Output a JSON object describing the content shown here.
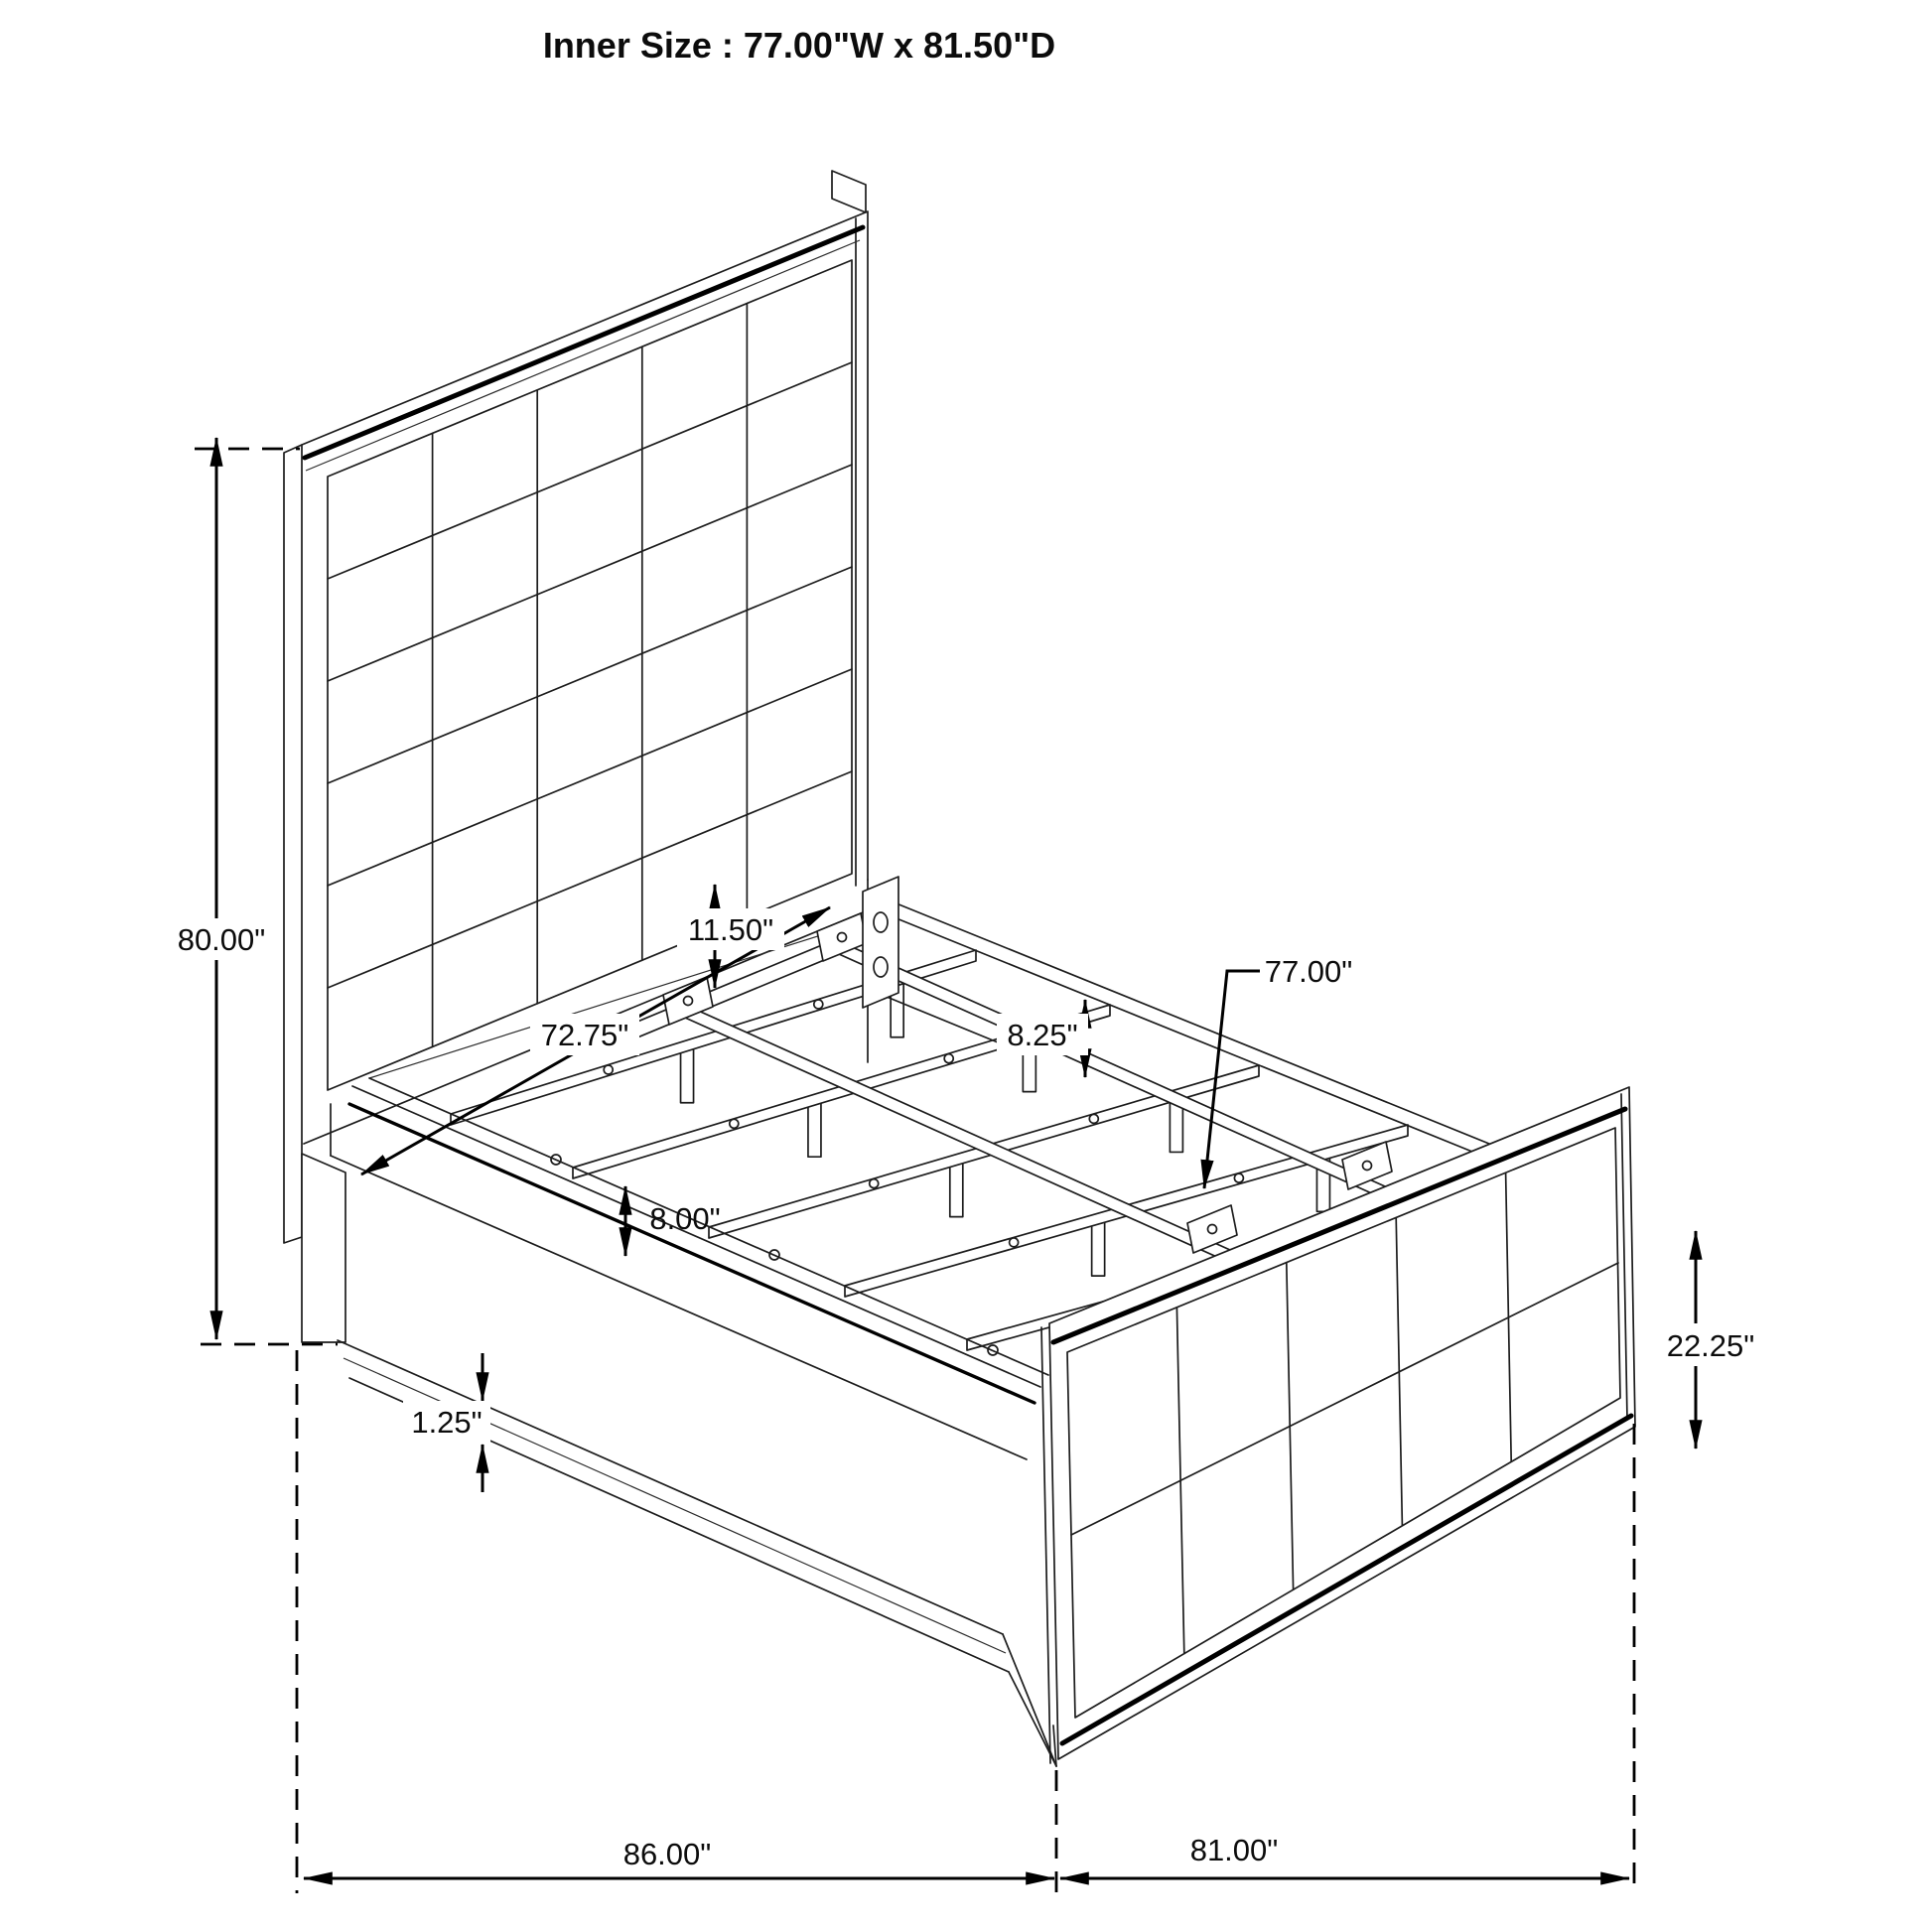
{
  "title": "Inner Size : 77.00\"W x 81.50\"D",
  "inner_size": {
    "width": "77.00\"W",
    "depth": "81.50\"D"
  },
  "dimensions": {
    "headboard_height": {
      "label": "80.00\""
    },
    "headboard_to_slat": {
      "label": "11.50\""
    },
    "inner_rail_length": {
      "label": "72.75\""
    },
    "rail_height": {
      "label": "8.25\""
    },
    "slat_length": {
      "label": "77.00\""
    },
    "leg_height": {
      "label": "8.00\""
    },
    "base_trim_thickness": {
      "label": "1.25\""
    },
    "footboard_height": {
      "label": "22.25\""
    },
    "overall_width": {
      "label": "86.00\""
    },
    "overall_depth": {
      "label": "81.00\""
    }
  }
}
